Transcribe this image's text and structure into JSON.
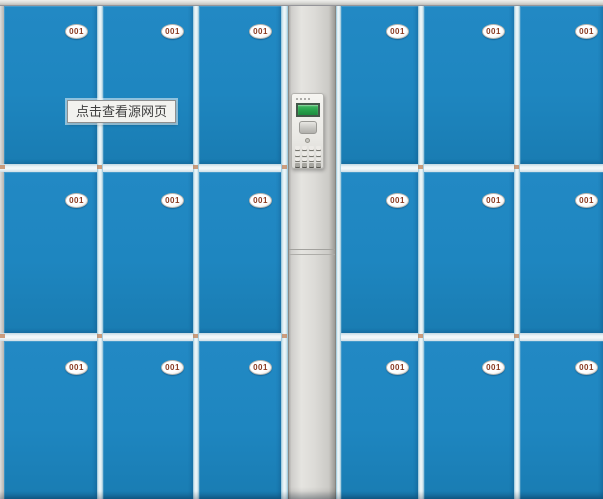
{
  "image_preview": {
    "tooltip": {
      "text": "点击查看源网页"
    }
  },
  "cabinet": {
    "rows": 3,
    "columns": 6,
    "lockers": [
      [
        "001",
        "001",
        "001",
        "001",
        "001",
        "001"
      ],
      [
        "001",
        "001",
        "001",
        "001",
        "001",
        "001"
      ],
      [
        "001",
        "001",
        "001",
        "001",
        "001",
        "001"
      ]
    ],
    "control_panel": {
      "display_icon": "lcd-display",
      "speaker_icon": "speaker-grille",
      "keypad_icon": "numeric-keypad",
      "keypad_rows": 4,
      "keypad_columns": 4
    }
  },
  "colors": {
    "locker_blue": "#1d86c0",
    "divider_light": "#eaf3f6",
    "frame_gray": "#dcdbd7",
    "lcd_green": "#2aa64e",
    "badge_text": "#8a3b22",
    "tooltip_bg": "#f2f2ef",
    "tooltip_border": "#8f8f8f"
  }
}
